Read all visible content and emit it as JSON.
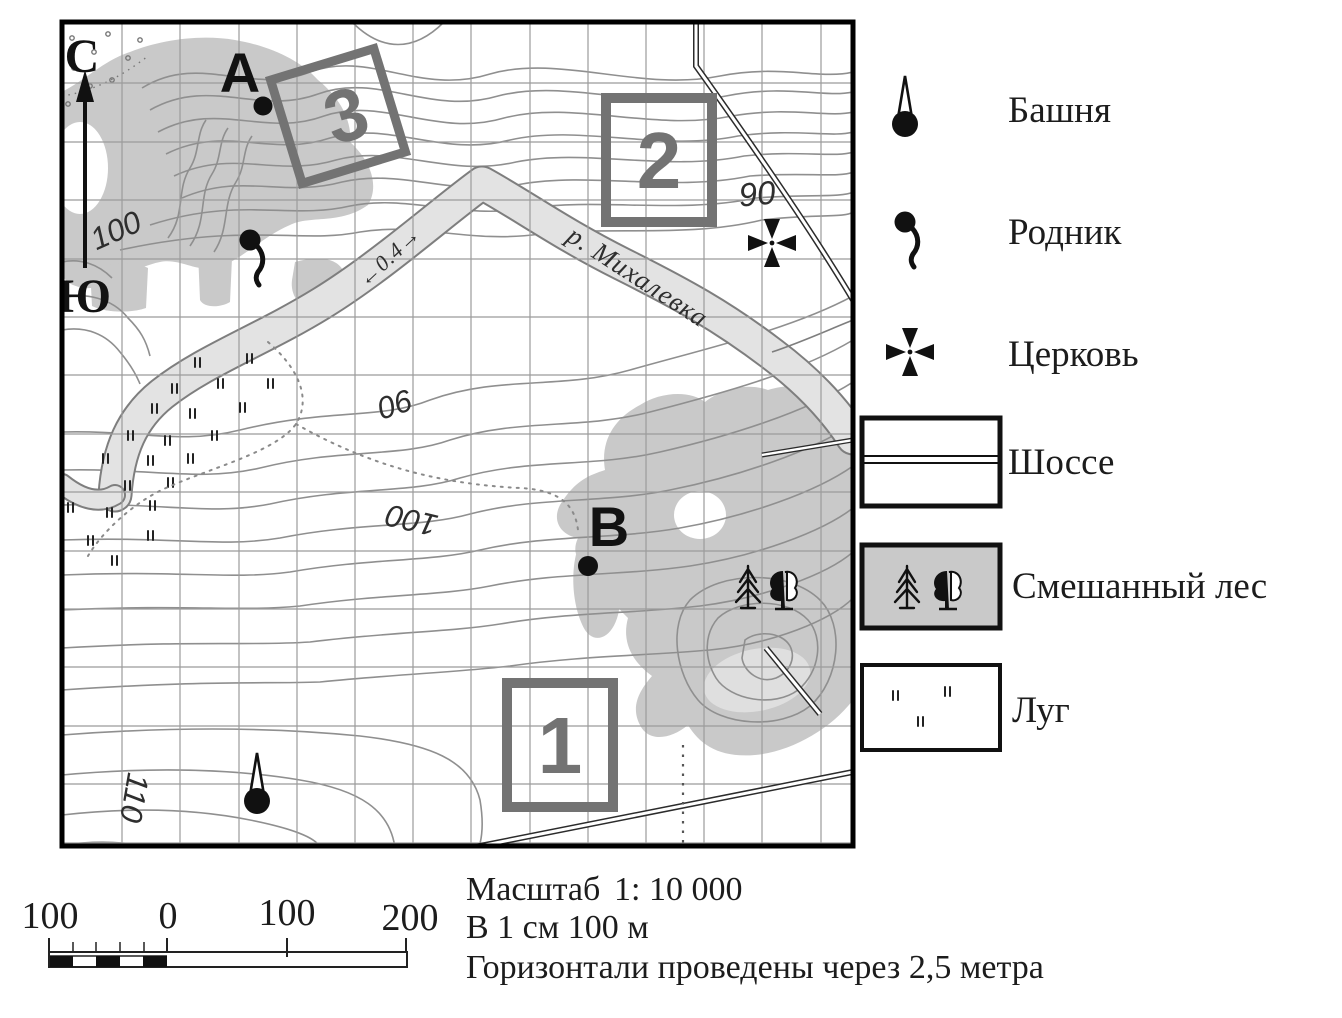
{
  "map": {
    "compass": {
      "north": "С",
      "south": "Ю"
    },
    "points": {
      "a": "А",
      "b": "В"
    },
    "squares": [
      {
        "label": "3"
      },
      {
        "label": "2"
      },
      {
        "label": "1"
      }
    ],
    "river": {
      "name": "р. Михалевка",
      "width_label": "←0.4→"
    },
    "elevations": {
      "west_100": "100",
      "mid_90": "90",
      "mid_100": "100",
      "south_110": "110",
      "church_90": "90"
    }
  },
  "legend": {
    "items": [
      {
        "icon": "tower-icon",
        "label": "Башня"
      },
      {
        "icon": "spring-icon",
        "label": "Родник"
      },
      {
        "icon": "church-icon",
        "label": "Церковь"
      },
      {
        "icon": "highway-swatch",
        "label": "Шоссе"
      },
      {
        "icon": "forest-swatch",
        "label": "Смешанный лес"
      },
      {
        "icon": "meadow-swatch",
        "label": "Луг"
      }
    ]
  },
  "scale": {
    "bar_labels": [
      "100",
      "0",
      "100",
      "200"
    ],
    "title_label": "Масштаб",
    "ratio": "1: 10 000",
    "equiv": "В 1 см 100 м",
    "contour_note": "Горизонтали проведены через 2,5 метра"
  },
  "colors": {
    "forest": "#c9c9c9",
    "clearing": "#dfdfdf",
    "river_fill": "#e3e3e3",
    "river_edge": "#7e7e7e",
    "contour": "#8f8f8f",
    "grid": "#9b9b9b",
    "square": "#737373"
  }
}
